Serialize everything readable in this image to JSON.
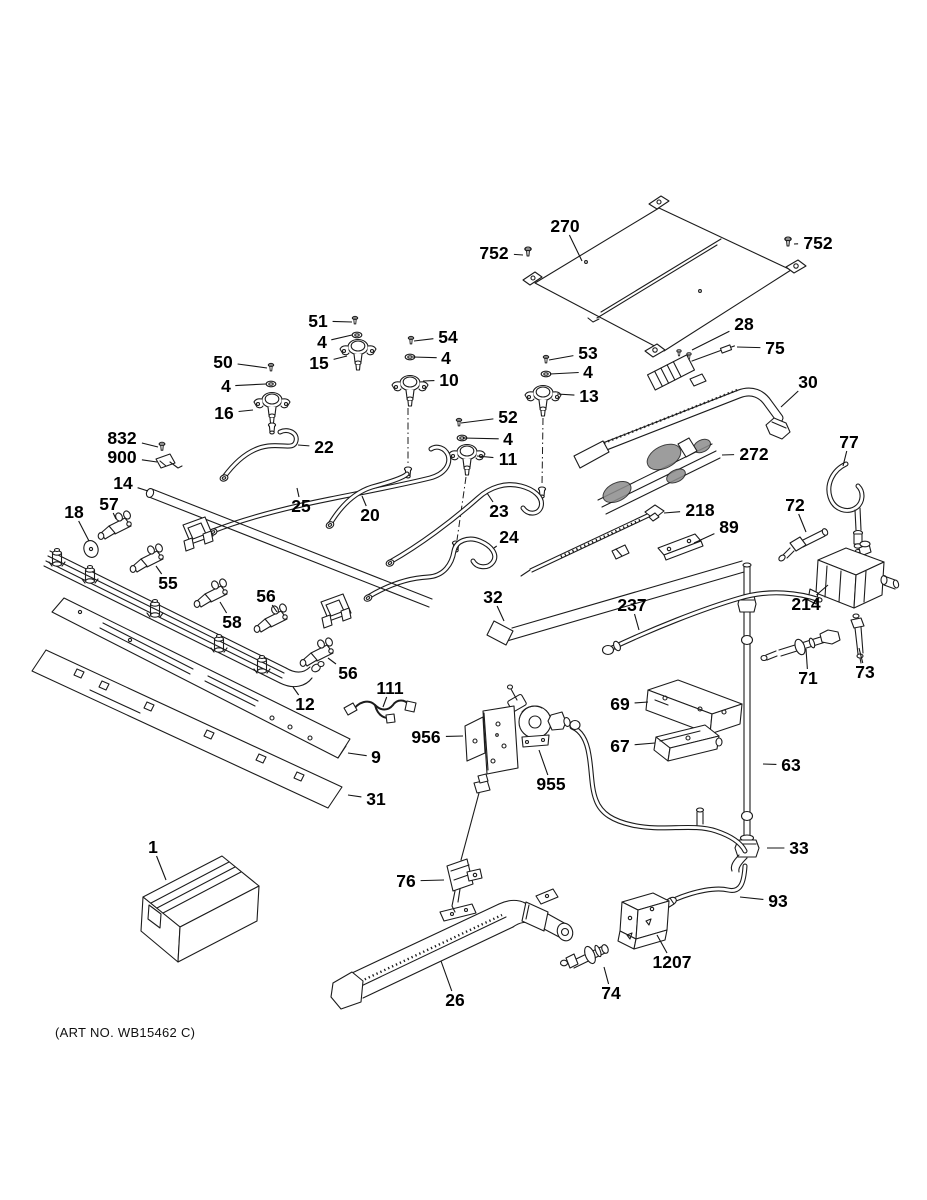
{
  "caption": {
    "art_no": "(ART NO. WB15462 C)"
  },
  "colors": {
    "line": "#1c1c1c",
    "label": "#000000",
    "background": "#ffffff"
  },
  "callouts": [
    {
      "label": "270",
      "x": 565,
      "y": 226,
      "tx": 582,
      "ty": 261
    },
    {
      "label": "752",
      "x": 494,
      "y": 253,
      "tx": 523,
      "ty": 255
    },
    {
      "label": "752",
      "x": 818,
      "y": 243,
      "tx": 794,
      "ty": 244
    },
    {
      "label": "51",
      "x": 318,
      "y": 321,
      "tx": 352,
      "ty": 322
    },
    {
      "label": "4",
      "x": 322,
      "y": 342,
      "tx": 352,
      "ty": 335
    },
    {
      "label": "54",
      "x": 448,
      "y": 337,
      "tx": 414,
      "ty": 341
    },
    {
      "label": "15",
      "x": 319,
      "y": 363,
      "tx": 347,
      "ty": 356
    },
    {
      "label": "4",
      "x": 446,
      "y": 358,
      "tx": 413,
      "ty": 357
    },
    {
      "label": "10",
      "x": 449,
      "y": 380,
      "tx": 423,
      "ty": 381
    },
    {
      "label": "50",
      "x": 223,
      "y": 362,
      "tx": 267,
      "ty": 368
    },
    {
      "label": "4",
      "x": 226,
      "y": 386,
      "tx": 266,
      "ty": 384
    },
    {
      "label": "16",
      "x": 224,
      "y": 413,
      "tx": 253,
      "ty": 410
    },
    {
      "label": "53",
      "x": 588,
      "y": 353,
      "tx": 549,
      "ty": 360
    },
    {
      "label": "4",
      "x": 588,
      "y": 372,
      "tx": 550,
      "ty": 374
    },
    {
      "label": "13",
      "x": 589,
      "y": 396,
      "tx": 557,
      "ty": 394
    },
    {
      "label": "28",
      "x": 744,
      "y": 324,
      "tx": 692,
      "ty": 350
    },
    {
      "label": "75",
      "x": 775,
      "y": 348,
      "tx": 737,
      "ty": 347
    },
    {
      "label": "30",
      "x": 808,
      "y": 382,
      "tx": 781,
      "ty": 407
    },
    {
      "label": "832",
      "x": 122,
      "y": 438,
      "tx": 158,
      "ty": 447
    },
    {
      "label": "900",
      "x": 122,
      "y": 457,
      "tx": 157,
      "ty": 462
    },
    {
      "label": "22",
      "x": 324,
      "y": 447,
      "tx": 298,
      "ty": 445
    },
    {
      "label": "52",
      "x": 508,
      "y": 417,
      "tx": 461,
      "ty": 423
    },
    {
      "label": "4",
      "x": 508,
      "y": 439,
      "tx": 463,
      "ty": 438
    },
    {
      "label": "11",
      "x": 508,
      "y": 459,
      "tx": 477,
      "ty": 456
    },
    {
      "label": "272",
      "x": 754,
      "y": 454,
      "tx": 722,
      "ty": 455
    },
    {
      "label": "14",
      "x": 123,
      "y": 483,
      "tx": 148,
      "ty": 491
    },
    {
      "label": "57",
      "x": 109,
      "y": 504,
      "tx": 116,
      "ty": 519
    },
    {
      "label": "18",
      "x": 74,
      "y": 512,
      "tx": 89,
      "ty": 541
    },
    {
      "label": "25",
      "x": 301,
      "y": 506,
      "tx": 297,
      "ty": 488
    },
    {
      "label": "20",
      "x": 370,
      "y": 515,
      "tx": 362,
      "ty": 496
    },
    {
      "label": "23",
      "x": 499,
      "y": 511,
      "tx": 487,
      "ty": 493
    },
    {
      "label": "218",
      "x": 700,
      "y": 510,
      "tx": 664,
      "ty": 513
    },
    {
      "label": "89",
      "x": 729,
      "y": 527,
      "tx": 694,
      "ty": 543
    },
    {
      "label": "72",
      "x": 795,
      "y": 505,
      "tx": 806,
      "ty": 532
    },
    {
      "label": "77",
      "x": 849,
      "y": 442,
      "tx": 843,
      "ty": 466
    },
    {
      "label": "55",
      "x": 168,
      "y": 583,
      "tx": 156,
      "ty": 566
    },
    {
      "label": "24",
      "x": 509,
      "y": 537,
      "tx": 494,
      "ty": 548
    },
    {
      "label": "58",
      "x": 232,
      "y": 622,
      "tx": 220,
      "ty": 602
    },
    {
      "label": "56",
      "x": 266,
      "y": 596,
      "tx": 277,
      "ty": 612
    },
    {
      "label": "32",
      "x": 493,
      "y": 597,
      "tx": 504,
      "ty": 621
    },
    {
      "label": "237",
      "x": 632,
      "y": 605,
      "tx": 639,
      "ty": 630
    },
    {
      "label": "214",
      "x": 806,
      "y": 604,
      "tx": 828,
      "ty": 585
    },
    {
      "label": "71",
      "x": 808,
      "y": 678,
      "tx": 806,
      "ty": 649
    },
    {
      "label": "73",
      "x": 865,
      "y": 672,
      "tx": 859,
      "ty": 648
    },
    {
      "label": "56",
      "x": 348,
      "y": 673,
      "tx": 328,
      "ty": 658
    },
    {
      "label": "12",
      "x": 305,
      "y": 704,
      "tx": 293,
      "ty": 687
    },
    {
      "label": "111",
      "x": 390,
      "y": 688,
      "tx": 383,
      "ty": 707
    },
    {
      "label": "69",
      "x": 620,
      "y": 704,
      "tx": 648,
      "ty": 702
    },
    {
      "label": "956",
      "x": 426,
      "y": 737,
      "tx": 463,
      "ty": 736
    },
    {
      "label": "67",
      "x": 620,
      "y": 746,
      "tx": 655,
      "ty": 743
    },
    {
      "label": "9",
      "x": 376,
      "y": 757,
      "tx": 348,
      "ty": 753
    },
    {
      "label": "955",
      "x": 551,
      "y": 784,
      "tx": 539,
      "ty": 750
    },
    {
      "label": "63",
      "x": 791,
      "y": 765,
      "tx": 763,
      "ty": 764
    },
    {
      "label": "31",
      "x": 376,
      "y": 799,
      "tx": 348,
      "ty": 795
    },
    {
      "label": "33",
      "x": 799,
      "y": 848,
      "tx": 767,
      "ty": 848
    },
    {
      "label": "1",
      "x": 153,
      "y": 847,
      "tx": 166,
      "ty": 880
    },
    {
      "label": "76",
      "x": 406,
      "y": 881,
      "tx": 444,
      "ty": 880
    },
    {
      "label": "93",
      "x": 778,
      "y": 901,
      "tx": 740,
      "ty": 897
    },
    {
      "label": "1207",
      "x": 672,
      "y": 962,
      "tx": 657,
      "ty": 935
    },
    {
      "label": "26",
      "x": 455,
      "y": 1000,
      "tx": 441,
      "ty": 961
    },
    {
      "label": "74",
      "x": 611,
      "y": 993,
      "tx": 604,
      "ty": 967
    }
  ]
}
